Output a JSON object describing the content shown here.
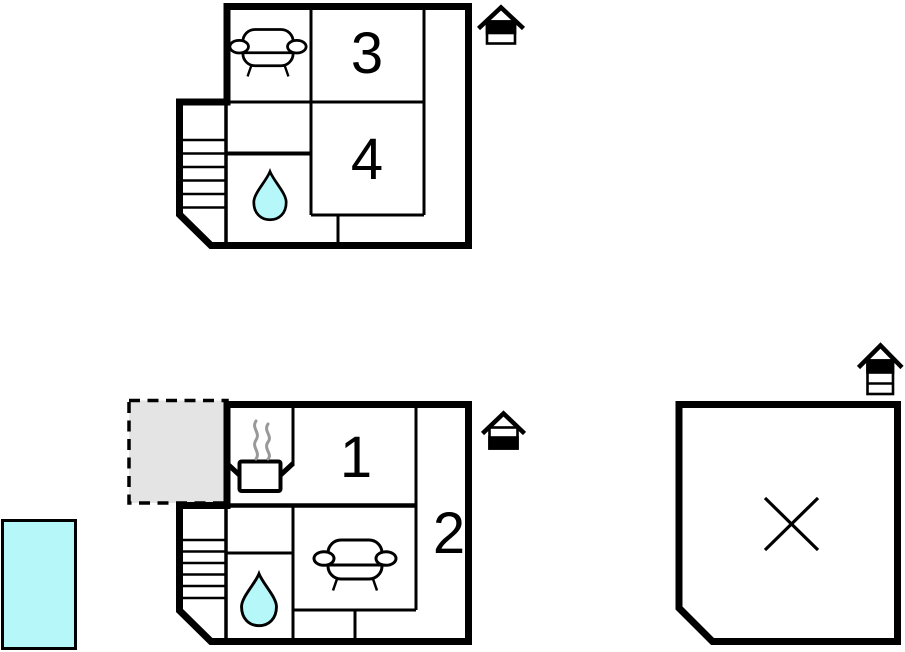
{
  "floorplan": {
    "upper_floor": {
      "rooms": [
        {
          "label": "3"
        },
        {
          "label": "4"
        }
      ],
      "features": [
        "sofa",
        "staircase",
        "shower-water-drop"
      ],
      "house_level_icon": "house-upper-floor-highlighted"
    },
    "ground_floor": {
      "rooms": [
        {
          "label": "1"
        },
        {
          "label": "2"
        }
      ],
      "features": [
        "kitchen-stove",
        "steam",
        "sofa",
        "staircase",
        "shower-water-drop",
        "dashed-terrace"
      ],
      "house_level_icon": "house-ground-floor-highlighted"
    },
    "outbuilding": {
      "marker": "x-cross",
      "house_level_icon": "house-attic-highlighted"
    },
    "pool": {
      "feature": "swimming-pool"
    }
  },
  "colors": {
    "wall": "#000000",
    "water_fill": "#b6f7fa",
    "terrace_fill": "#e4e4e4",
    "steam_stroke": "#999999"
  }
}
